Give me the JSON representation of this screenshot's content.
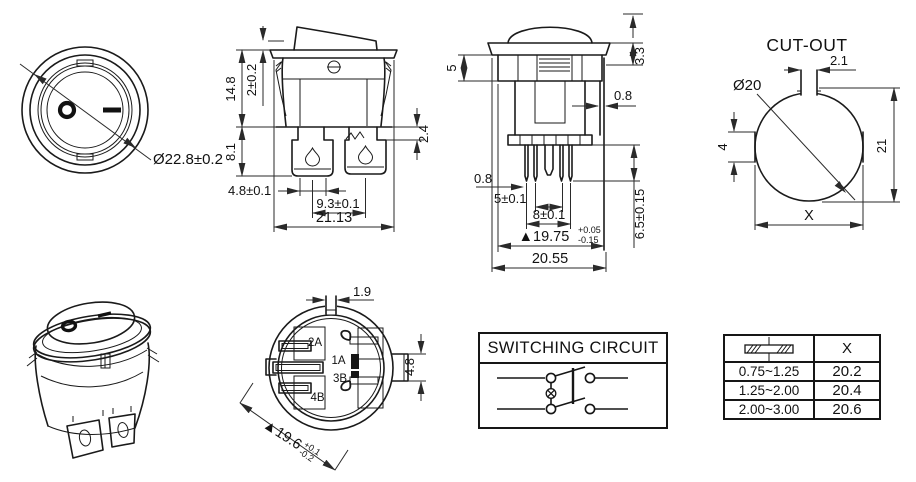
{
  "views": {
    "front": {
      "dia": "Ø22.8±0.2"
    },
    "side_a": {
      "h_total": "14.8",
      "h_rocker": "2±0.2",
      "h_term": "8.1",
      "step": "2.4",
      "term_w": "4.8±0.1",
      "pitch": "9.3±0.1",
      "width": "21.13"
    },
    "side_b": {
      "bezel": "5",
      "flange": "3.3",
      "wall": "0.8",
      "pin_w": "0.8",
      "pitch_a": "5±0.1",
      "pitch_b": "8±0.1",
      "pin_len": "6.5±0.15",
      "mount": "▲19.75",
      "tol_p": "+0.05",
      "tol_m": "-0.15",
      "overall": "20.55"
    },
    "cutout": {
      "title": "CUT-OUT",
      "slot": "2.1",
      "dia": "Ø20",
      "flat": "4",
      "height": "21",
      "width": "X"
    },
    "bottom": {
      "slot": "1.9",
      "tab": "4.8",
      "mount": "▲19.6",
      "tol_p": "+0.1",
      "tol_m": "-0.2",
      "t_2a": "2A",
      "t_1a": "1A",
      "t_3b": "3B",
      "t_4b": "4B"
    }
  },
  "circuit": {
    "title": "SWITCHING CIRCUIT"
  },
  "table": {
    "header_x": "X",
    "rows": [
      {
        "range": "0.75~1.25",
        "x": "20.2"
      },
      {
        "range": "1.25~2.00",
        "x": "20.4"
      },
      {
        "range": "2.00~3.00",
        "x": "20.6"
      }
    ]
  },
  "colors": {
    "line": "#1a1a1a",
    "background": "#ffffff"
  }
}
